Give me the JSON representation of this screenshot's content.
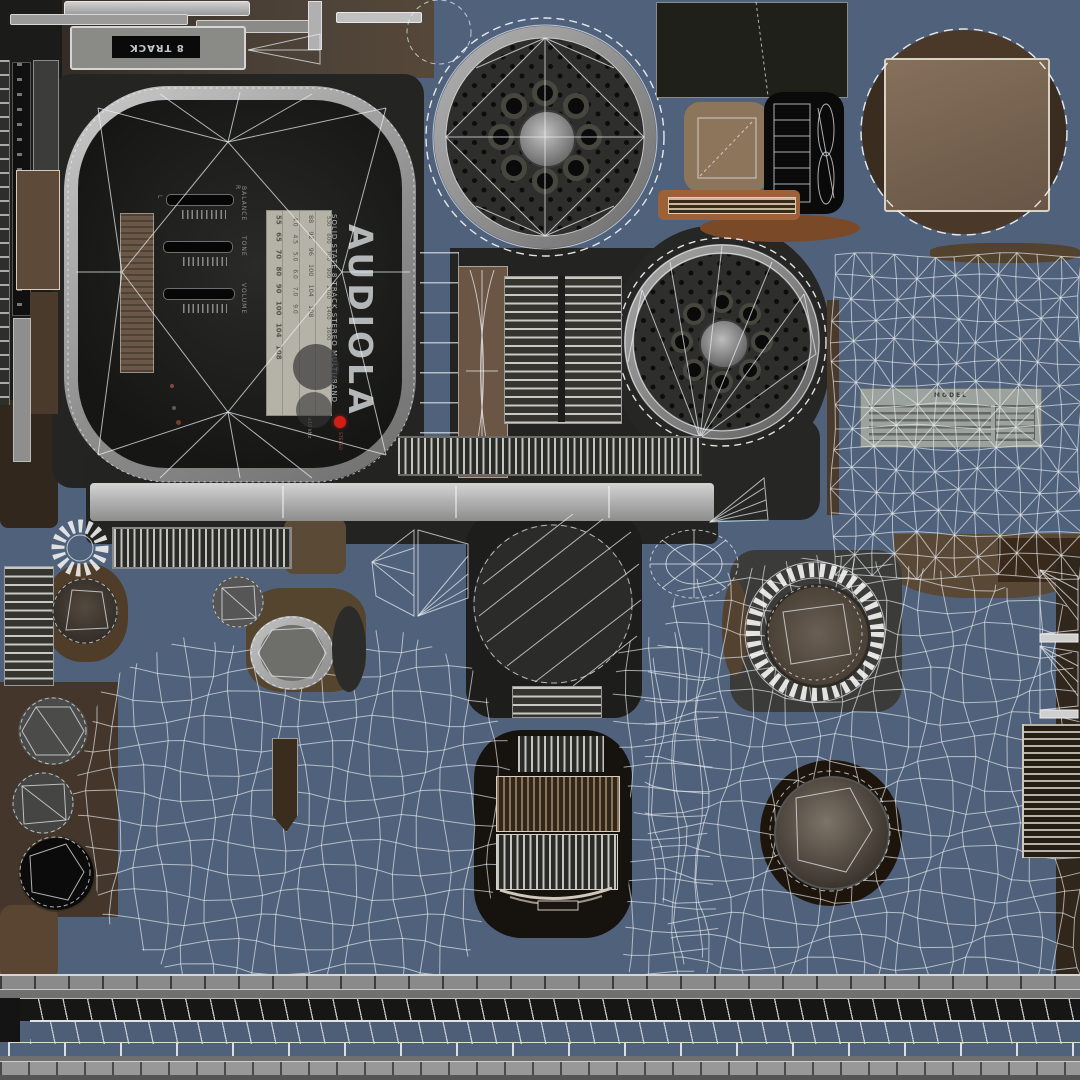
{
  "colors": {
    "background": "#50627b",
    "panel_dark": "#242422",
    "panel_black": "#141412",
    "metal_light": "#b9b9b9",
    "metal_mid": "#8f8f8f",
    "wood": "#6b5747",
    "wood_dark": "#45372a",
    "wood_orange": "#9c6136",
    "wire": "#e9ebee",
    "dial_bg": "#b5b2a8",
    "speaker_dark": "#2e2e2c",
    "accent_red": "#cf1f17",
    "blue_strip": "#4d5e76",
    "label_gray": "#a4a8a2"
  },
  "labels": {
    "eight_track": "8 TRACK",
    "brand": "AUDIOLA",
    "tagline": "SOLID STATE 8 TRACK STEREO MULTI/BAND",
    "stereo": "STEREO",
    "spec_model": "MODEL",
    "dial_unit": "x10 kHz",
    "balance_left": "L",
    "balance_right": "R"
  },
  "sliders": [
    {
      "label": "BALANCE"
    },
    {
      "label": "TONE"
    },
    {
      "label": "VOLUME"
    }
  ],
  "dial": {
    "bands": [
      "55 65 70 80 90 100 104 108",
      "4.0 4.5 5.0 6.0 7.0 9.0",
      "88 92 96 100 104 108",
      "530 600 700 900 1100 1400 1600"
    ]
  }
}
